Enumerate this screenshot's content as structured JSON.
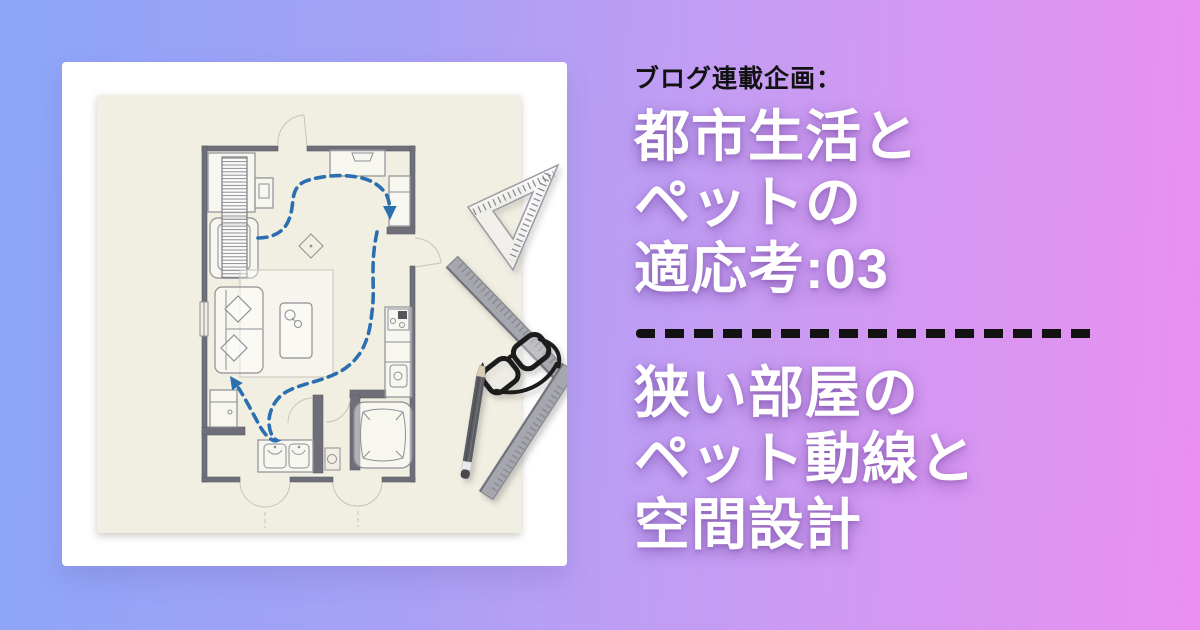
{
  "css_vars": {
    "bg-from": "#8ca6f8",
    "bg-mid": "#c39df3",
    "bg-to": "#ea90f0",
    "ink": "#121212",
    "title": "#ffffff",
    "route": "#2b6fb0",
    "paper": "#f1eee2",
    "wall": "#6f6f7a"
  },
  "kicker": {
    "label": "ブログ連載企画："
  },
  "title_top": {
    "lines": [
      "都市生活と",
      "ペットの",
      "適応考:03"
    ]
  },
  "title_bottom": {
    "lines": [
      "狭い部屋の",
      "ペット動線と",
      "空間設計"
    ]
  },
  "illustration": {
    "subject": "floor-plan-sketch-with-pet-route",
    "elements": [
      "floor-plan",
      "pet-route-dashed-arrows",
      "set-square",
      "steel-square-ruler",
      "glasses",
      "pencil"
    ],
    "route_color": "#2b6fb0",
    "paper_color": "#f1eee2"
  }
}
